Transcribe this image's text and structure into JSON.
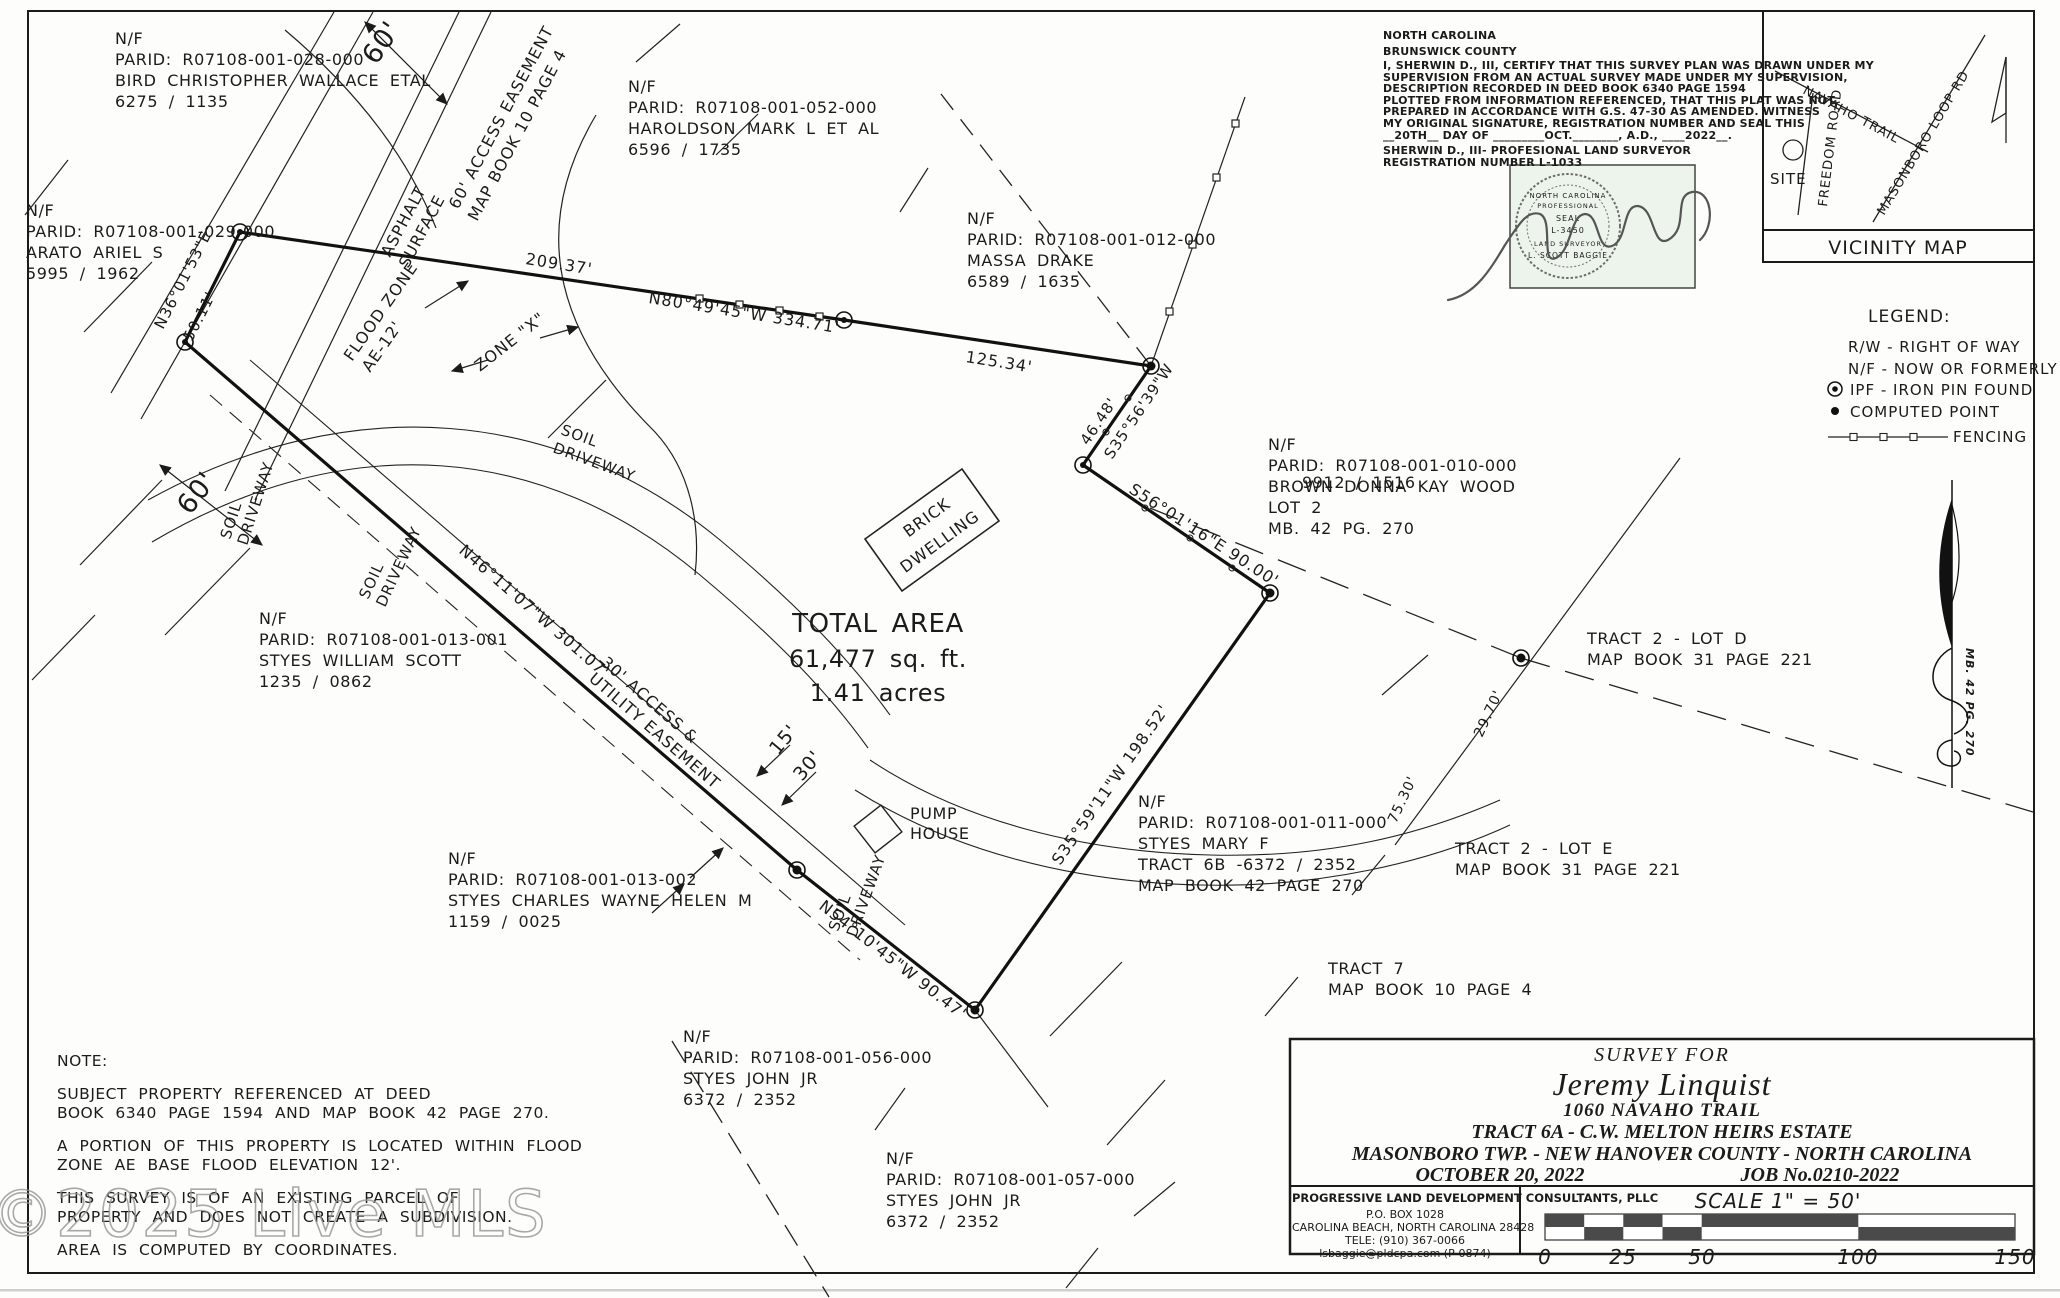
{
  "watermark": {
    "text": "©2025 Live MLS"
  },
  "certificate": {
    "lines": [
      "NORTH CAROLINA",
      "BRUNSWICK COUNTY",
      "I, SHERWIN D., III, CERTIFY THAT THIS SURVEY PLAN WAS DRAWN UNDER MY",
      "SUPERVISION FROM AN ACTUAL SURVEY MADE UNDER MY SUPERVISION,",
      "DESCRIPTION RECORDED IN DEED BOOK 6340 PAGE 1594",
      "PLOTTED FROM INFORMATION REFERENCED, THAT THIS PLAT WAS NOT",
      "PREPARED IN ACCORDANCE WITH G.S. 47-30 AS AMENDED. WITNESS",
      "MY ORIGINAL SIGNATURE, REGISTRATION NUMBER AND SEAL THIS",
      "__20TH__ DAY OF _________OCT.________, A.D., ____2022__.",
      "SHERWIN D., III- PROFESIONAL LAND SURVEYOR",
      "REGISTRATION NUMBER L-1033"
    ]
  },
  "seal": {
    "l1": "NORTH CAROLINA",
    "l2": "PROFESSIONAL",
    "l3": "SEAL",
    "l4": "L-3450",
    "l5": "LAND SURVEYOR",
    "l6": "L. SCOTT BAGGIE"
  },
  "vicinity": {
    "title": "VICINITY MAP",
    "site": "SITE",
    "navaho": "NAVAHO TRAIL",
    "freedom": "FREEDOM ROAD",
    "masonboro": "MASONBORO LOOP RD"
  },
  "legend": {
    "title": "LEGEND:",
    "rw": "R/W - RIGHT OF WAY",
    "nf": "N/F - NOW OR FORMERLY",
    "ipf": "IPF - IRON PIN FOUND",
    "cp": "COMPUTED POINT",
    "fence": "FENCING"
  },
  "north_arrow": {
    "label": "MB. 42 PG. 270"
  },
  "total_area": {
    "l1": "TOTAL AREA",
    "l2": "61,477 sq. ft.",
    "l3": "1.41 acres"
  },
  "building": {
    "l1": "BRICK",
    "l2": "DWELLING"
  },
  "pump": {
    "l1": "PUMP",
    "l2": "HOUSE"
  },
  "overlap_ref": "9912 / 1516",
  "parcels": [
    {
      "lines": [
        "N/F",
        "PARID: R07108-001-028-000",
        "BIRD CHRISTOPHER WALLACE ETAL",
        "6275 / 1135"
      ]
    },
    {
      "lines": [
        "N/F",
        "PARID: R07108-001-029-000",
        "ARATO ARIEL S",
        "5995 / 1962"
      ]
    },
    {
      "lines": [
        "N/F",
        "PARID: R07108-001-052-000",
        "HAROLDSON MARK L ET AL",
        "6596 / 1735"
      ]
    },
    {
      "lines": [
        "N/F",
        "PARID: R07108-001-012-000",
        "MASSA DRAKE",
        "6589 / 1635"
      ]
    },
    {
      "lines": [
        "N/F",
        "PARID: R07108-001-010-000",
        "BROWN DONNA KAY WOOD",
        "LOT 2",
        "MB. 42 PG. 270"
      ]
    },
    {
      "lines": [
        "N/F",
        "PARID: R07108-001-013-001",
        "STYES WILLIAM SCOTT",
        "1235 / 0862"
      ]
    },
    {
      "lines": [
        "N/F",
        "PARID: R07108-001-011-000",
        "STYES MARY F",
        "TRACT 6B -6372 / 2352",
        "MAP BOOK 42 PAGE 270"
      ]
    },
    {
      "lines": [
        "N/F",
        "PARID: R07108-001-013-002",
        "STYES CHARLES WAYNE HELEN M",
        "1159 / 0025"
      ]
    },
    {
      "lines": [
        "N/F",
        "PARID: R07108-001-056-000",
        "STYES JOHN JR",
        "6372 / 2352"
      ]
    },
    {
      "lines": [
        "N/F",
        "PARID: R07108-001-057-000",
        "STYES JOHN JR",
        "6372 / 2352"
      ]
    },
    {
      "lines": [
        "TRACT 2 - LOT D",
        "MAP BOOK 31 PAGE 221"
      ]
    },
    {
      "lines": [
        "TRACT 2 - LOT E",
        "MAP BOOK 31 PAGE 221"
      ]
    },
    {
      "lines": [
        "TRACT 7",
        "MAP BOOK 10 PAGE 4"
      ]
    }
  ],
  "bearings": [
    "209.37'",
    "N80°49'45\"W  334.71'",
    "125.34'",
    "60'",
    "60'",
    "N36°01'53\"E",
    "50.11'",
    "ASPHALT",
    "SURFACE",
    "60' ACCESS EASEMENT",
    "MAP BOOK 10 PAGE 4",
    "FLOOD ZONE",
    "AE-12'",
    "ZONE \"X\"",
    "SOIL",
    "DRIVEWAY",
    "SOIL",
    "DRIVEWAY",
    "SOIL",
    "DRIVEWAY",
    "SOIL",
    "DRIVEWAY",
    "46.48'",
    "S35°56'39\"W",
    "S56°01'16\"E  90.00'",
    "S35°59'11\"W  198.52'",
    "N54°10'45\"W  90.47'",
    "N46°11'07\"W  301.07'",
    "30' ACCESS &",
    "UTILITY EASEMENT",
    "15'",
    "30'",
    "29.70'",
    "75.30'"
  ],
  "titleblock": {
    "survey_for": "SURVEY FOR",
    "client": "Jeremy Linquist",
    "address": "1060 NAVAHO TRAIL",
    "tract": "TRACT 6A - C.W. MELTON HEIRS ESTATE",
    "township": "MASONBORO TWP. - NEW HANOVER COUNTY - NORTH CAROLINA",
    "date": "OCTOBER 20, 2022",
    "job": "JOB No.0210-2022"
  },
  "firm": {
    "name": "PROGRESSIVE LAND DEVELOPMENT CONSULTANTS, PLLC",
    "addr1": "P.O. BOX 1028",
    "addr2": "CAROLINA BEACH, NORTH CAROLINA 28428",
    "tel": "TELE: (910) 367-0066",
    "email": "lsbaggie@pldcpa.com (P-0874)"
  },
  "scalebar": {
    "title": "SCALE 1\" = 50'",
    "t0": "0",
    "t1": "25",
    "t2": "50",
    "t3": "100",
    "t4": "150"
  },
  "notes": {
    "title": "NOTE:",
    "n1a": "SUBJECT PROPERTY REFERENCED AT DEED",
    "n1b": "BOOK 6340 PAGE 1594 AND MAP BOOK 42 PAGE 270.",
    "n2a": "A PORTION OF THIS PROPERTY IS LOCATED WITHIN FLOOD",
    "n2b": "ZONE AE BASE FLOOD ELEVATION 12'.",
    "n3a": "THIS SURVEY IS OF AN EXISTING PARCEL OF",
    "n3b": "PROPERTY AND DOES NOT CREATE A SUBDIVISION.",
    "n4": "AREA IS COMPUTED BY COORDINATES."
  }
}
